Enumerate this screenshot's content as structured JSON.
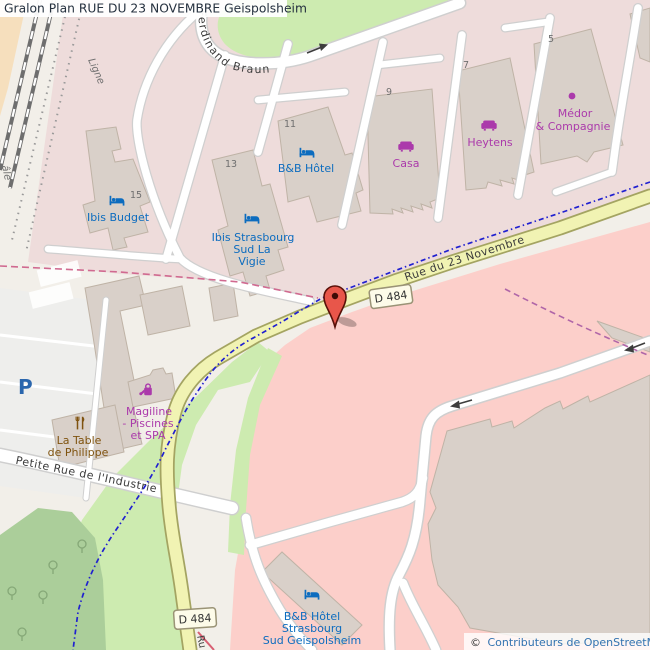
{
  "header": {
    "title": "Gralon Plan RUE DU 23 NOVEMBRE Geispolsheim"
  },
  "attribution": {
    "copyright": "©",
    "label": "Contributeurs de OpenStreetMap"
  },
  "roads": {
    "d484_shield": "D 484",
    "rue_23_novembre": "Rue du 23 Novembre",
    "ferdinand_braun": "Ferdinand Braun",
    "petite_rue_industrie": "Petite Rue de l'Industrie",
    "rue_fragment": "Ru"
  },
  "railway": {
    "line_fragment": "Ligne",
    "line_fragment_2": "âle"
  },
  "parking": {
    "symbol": "P"
  },
  "pois": {
    "ibis_budget": {
      "name": "Ibis Budget",
      "number": "15"
    },
    "ibis_vigie": {
      "lines": [
        "Ibis Strasbourg",
        "Sud La",
        "Vigie"
      ],
      "number": "13"
    },
    "bb_hotel": {
      "name": "B&B Hôtel",
      "number": "11"
    },
    "casa": {
      "name": "Casa",
      "number": "9"
    },
    "heytens": {
      "name": "Heytens",
      "number": "7"
    },
    "medor": {
      "lines": [
        "Médor",
        "& Compagnie"
      ],
      "number": "5"
    },
    "magiline": {
      "lines": [
        "Magiline",
        "- Piscines",
        "et SPA"
      ]
    },
    "table_philippe": {
      "lines": [
        "La Table",
        "de Philippe"
      ]
    },
    "bb_geispolsheim": {
      "lines": [
        "B&B Hôtel",
        "Strasbourg",
        "Sud Geispolsheim"
      ]
    }
  },
  "colors": {
    "background": "#f2efe9",
    "commercial_area": "#eedcdb",
    "retail_area": "#fccfca",
    "farmland": "#f6dfbd",
    "grass": "#cdebb0",
    "scrub": "#abce9a",
    "building": "#d9d0c9",
    "building_outline": "#bfb3a6",
    "road_secondary": "#f1f3b3",
    "road_secondary_casing": "#a4a462",
    "road_white": "#ffffff",
    "road_casing": "#cfcfcf",
    "cycleway": "#2020d0",
    "boundary_pink": "#d06a90",
    "boundary_purple": "#b066a8",
    "rail": "#6e6e6e",
    "parking_lot": "#eeeeec",
    "hotel_blue": "#0c6cbf",
    "shop_magenta": "#ab3aab",
    "restaurant_brown": "#7f530f",
    "parking_blue": "#2a66ad",
    "marker_red": "#e8564a",
    "shield_bg": "#fdfbe9",
    "shield_border": "#9a9376",
    "attribution_link": "#3272b0",
    "title_text": "#25313f"
  }
}
